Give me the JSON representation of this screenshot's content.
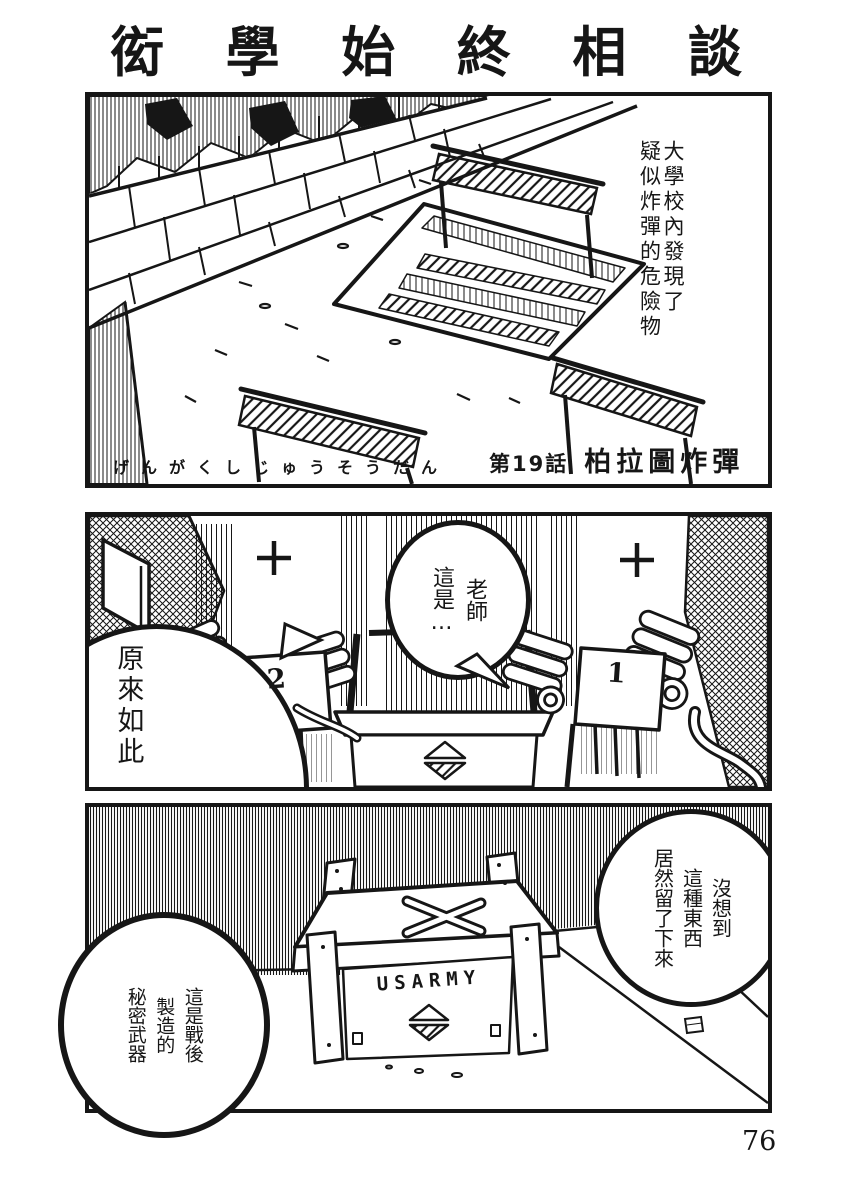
{
  "colors": {
    "ink": "#161616",
    "paper": "#ffffff"
  },
  "page": {
    "title": "衒學始終相談",
    "page_number": "76"
  },
  "panel1": {
    "narration": "大學校內發現了\n疑似炸彈的危險物",
    "caption_kana": "げんがくしじゅうそうだん",
    "chapter_label": "第19話",
    "chapter_title": "柏拉圖炸彈"
  },
  "panel2": {
    "bubble_teacher": "老師\n這是…",
    "bubble_left": "原來如此",
    "chair_left_number": "2",
    "chair_right_number": "1"
  },
  "panel3": {
    "bubble_right": "沒想到\n這種東西\n居然留了下來",
    "bubble_left": "這是戰後\n製造的\n秘密武器",
    "crate_label": "USARMY"
  }
}
